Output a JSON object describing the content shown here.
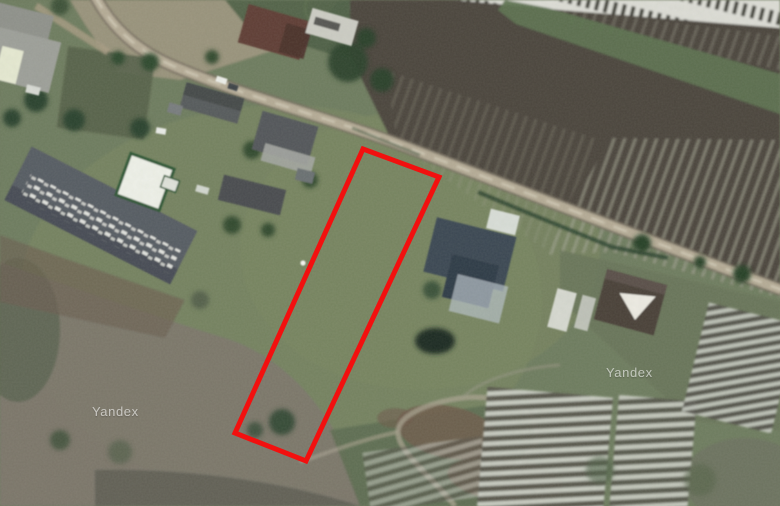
{
  "map": {
    "type": "satellite-imagery",
    "plot_outline": {
      "points": "363,149 439,177 306,461 235,433",
      "stroke_color": "#f2100f",
      "stroke_width": "5"
    },
    "watermarks": [
      {
        "label": "Yandex",
        "x": "92",
        "y": "416"
      },
      {
        "label": "Yandex",
        "x": "606",
        "y": "377"
      }
    ],
    "palette": {
      "grass_base": "#6e7b5e",
      "soil_field": "#4b453d",
      "scrub": "#7b766c",
      "road": "#b5ab96",
      "road_edge": "#756d5f",
      "greenhouse_stripe": "#cbcec5",
      "tree_green": "#2b422d",
      "barn_roof": "#565b63",
      "navy_roof": "#3a4653",
      "maroon_roof": "#5f3d35"
    }
  }
}
